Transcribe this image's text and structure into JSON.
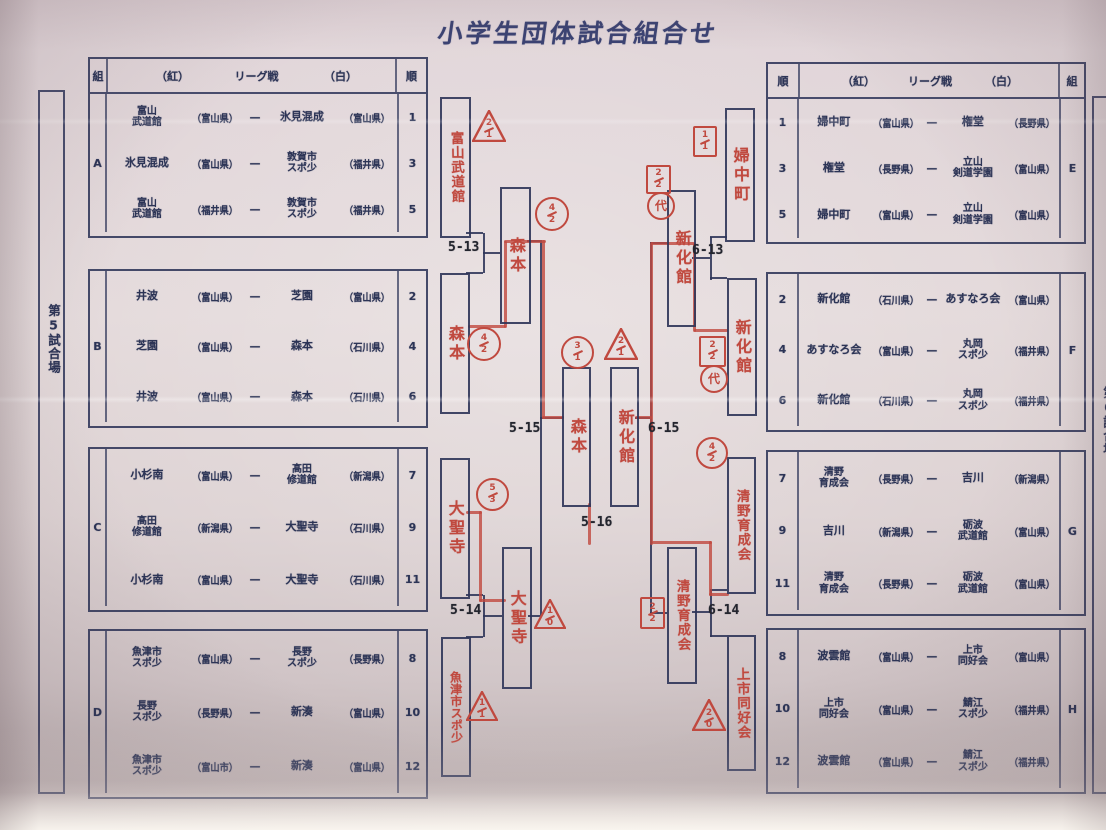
{
  "title": "小学生団体試合組合せ",
  "venue_left": "第5試合場",
  "venue_right": "第6試合場",
  "vs_dash": "—",
  "league_header": {
    "group": "組",
    "order": "順",
    "red": "（紅）",
    "league": "リーグ戦",
    "white": "（白）"
  },
  "left_tables": [
    {
      "group": "A",
      "rows": [
        {
          "order": "1",
          "red": "富山\n武道館",
          "red_pref": "（富山県）",
          "white": "氷見混成",
          "white_pref": "（富山県）"
        },
        {
          "order": "3",
          "red": "氷見混成",
          "red_pref": "（富山県）",
          "white": "敦賀市\nスポ少",
          "white_pref": "（福井県）"
        },
        {
          "order": "5",
          "red": "富山\n武道館",
          "red_pref": "（福井県）",
          "white": "敦賀市\nスポ少",
          "white_pref": "（福井県）"
        }
      ]
    },
    {
      "group": "B",
      "rows": [
        {
          "order": "2",
          "red": "井波",
          "red_pref": "（富山県）",
          "white": "芝園",
          "white_pref": "（富山県）"
        },
        {
          "order": "4",
          "red": "芝園",
          "red_pref": "（富山県）",
          "white": "森本",
          "white_pref": "（石川県）"
        },
        {
          "order": "6",
          "red": "井波",
          "red_pref": "（富山県）",
          "white": "森本",
          "white_pref": "（石川県）"
        }
      ]
    },
    {
      "group": "C",
      "rows": [
        {
          "order": "7",
          "red": "小杉南",
          "red_pref": "（富山県）",
          "white": "髙田\n修道館",
          "white_pref": "（新潟県）"
        },
        {
          "order": "9",
          "red": "髙田\n修道館",
          "red_pref": "（新潟県）",
          "white": "大聖寺",
          "white_pref": "（石川県）"
        },
        {
          "order": "11",
          "red": "小杉南",
          "red_pref": "（富山県）",
          "white": "大聖寺",
          "white_pref": "（石川県）"
        }
      ]
    },
    {
      "group": "D",
      "rows": [
        {
          "order": "8",
          "red": "魚津市\nスポ少",
          "red_pref": "（富山県）",
          "white": "長野\nスポ少",
          "white_pref": "（長野県）"
        },
        {
          "order": "10",
          "red": "長野\nスポ少",
          "red_pref": "（長野県）",
          "white": "新湊",
          "white_pref": "（富山県）"
        },
        {
          "order": "12",
          "red": "魚津市\nスポ少",
          "red_pref": "（富山市）",
          "white": "新湊",
          "white_pref": "（富山県）"
        }
      ]
    }
  ],
  "right_tables": [
    {
      "group": "E",
      "rows": [
        {
          "order": "1",
          "red": "婦中町",
          "red_pref": "（富山県）",
          "white": "権堂",
          "white_pref": "（長野県）"
        },
        {
          "order": "3",
          "red": "権堂",
          "red_pref": "（長野県）",
          "white": "立山\n剣道学園",
          "white_pref": "（富山県）"
        },
        {
          "order": "5",
          "red": "婦中町",
          "red_pref": "（富山県）",
          "white": "立山\n剣道学園",
          "white_pref": "（富山県）"
        }
      ]
    },
    {
      "group": "F",
      "rows": [
        {
          "order": "2",
          "red": "新化館",
          "red_pref": "（石川県）",
          "white": "あすなろ会",
          "white_pref": "（富山県）"
        },
        {
          "order": "4",
          "red": "あすなろ会",
          "red_pref": "（富山県）",
          "white": "丸岡\nスポ少",
          "white_pref": "（福井県）"
        },
        {
          "order": "6",
          "red": "新化館",
          "red_pref": "（石川県）",
          "white": "丸岡\nスポ少",
          "white_pref": "（福井県）"
        }
      ]
    },
    {
      "group": "G",
      "rows": [
        {
          "order": "7",
          "red": "清野\n育成会",
          "red_pref": "（長野県）",
          "white": "吉川",
          "white_pref": "（新潟県）"
        },
        {
          "order": "9",
          "red": "吉川",
          "red_pref": "（新潟県）",
          "white": "砺波\n武道館",
          "white_pref": "（富山県）"
        },
        {
          "order": "11",
          "red": "清野\n育成会",
          "red_pref": "（長野県）",
          "white": "砺波\n武道館",
          "white_pref": "（富山県）"
        }
      ]
    },
    {
      "group": "H",
      "rows": [
        {
          "order": "8",
          "red": "波雲館",
          "red_pref": "（富山県）",
          "white": "上市\n同好会",
          "white_pref": "（富山県）"
        },
        {
          "order": "10",
          "red": "上市\n同好会",
          "red_pref": "（富山県）",
          "white": "鯖江\nスポ少",
          "white_pref": "（福井県）"
        },
        {
          "order": "12",
          "red": "波雲館",
          "red_pref": "（富山県）",
          "white": "鯖江\nスポ少",
          "white_pref": "（福井県）"
        }
      ]
    }
  ],
  "bracket": {
    "boxes": [
      {
        "name": "富山武道館"
      },
      {
        "name": "森本"
      },
      {
        "name": "大聖寺"
      },
      {
        "name": "魚津市スポ少"
      },
      {
        "name": "森本"
      },
      {
        "name": "大聖寺"
      },
      {
        "name": "森本"
      },
      {
        "name": "新化館"
      },
      {
        "name": "新化館"
      },
      {
        "name": "清野育成会"
      },
      {
        "name": "婦中町"
      },
      {
        "name": "新化館"
      },
      {
        "name": "清野育成会"
      },
      {
        "name": "上市同好会"
      }
    ],
    "match_labels": [
      "5-13",
      "5-14",
      "5-15",
      "5-16",
      "6-13",
      "6-14",
      "6-15"
    ],
    "annotations": [
      {
        "shape": "triangle",
        "top": "2",
        "bottom": "1"
      },
      {
        "shape": "circle",
        "top": "4",
        "bottom": "2"
      },
      {
        "shape": "circle",
        "top": "4",
        "bottom": "2"
      },
      {
        "shape": "circle",
        "top": "3",
        "bottom": "1"
      },
      {
        "shape": "triangle",
        "top": "2",
        "bottom": "1"
      },
      {
        "shape": "circle",
        "top": "5",
        "bottom": "3"
      },
      {
        "shape": "triangle",
        "top": "1",
        "bottom": "0"
      },
      {
        "shape": "triangle",
        "top": "1",
        "bottom": "1"
      },
      {
        "shape": "square",
        "top": "1",
        "bottom": "1"
      },
      {
        "shape": "square",
        "top": "2",
        "bottom": "2"
      },
      {
        "shape": "circle",
        "char": "代"
      },
      {
        "shape": "square",
        "top": "2",
        "bottom": "2"
      },
      {
        "shape": "circle",
        "char": "代"
      },
      {
        "shape": "circle",
        "top": "4",
        "bottom": "2"
      },
      {
        "shape": "square",
        "top": "2",
        "bottom": "2"
      },
      {
        "shape": "triangle",
        "top": "2",
        "bottom": "0"
      }
    ]
  },
  "colors": {
    "ink": "#313a5e",
    "red_pen": "#c0493f",
    "paper": "#ded3d5"
  }
}
